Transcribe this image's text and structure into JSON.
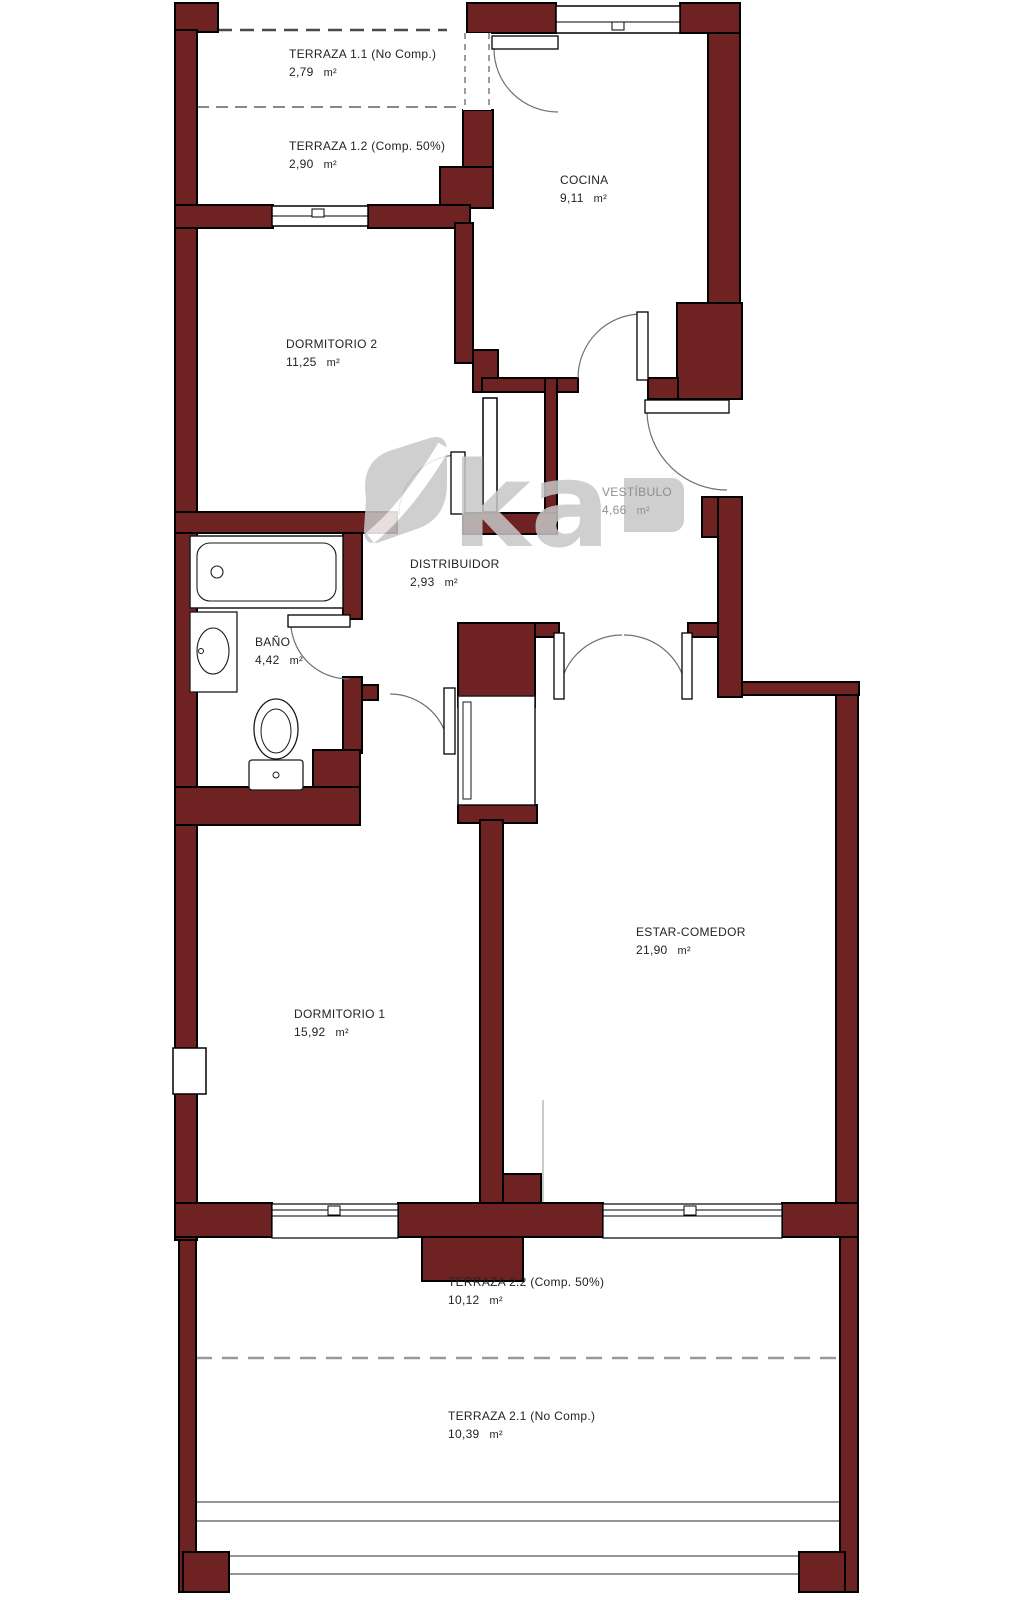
{
  "title": "Plano de vivienda (floor plan)",
  "unit": "m²",
  "colors": {
    "wall": "#6e2222",
    "outline": "#000000",
    "fixture_line": "#1a1a1a",
    "door_arc": "#6f6f6f",
    "dashed_line": "#8a8a8a",
    "watermark": "#c7c7c7",
    "label_text": "#232323",
    "label_text_muted": "#8f8f8f"
  },
  "watermark": {
    "text": "ka"
  },
  "fixtures": [
    "bathtub",
    "washbasin",
    "toilet",
    "wardrobe"
  ],
  "rooms": [
    {
      "id": "terraza-1-1",
      "name": "TERRAZA 1.1 (No Comp.)",
      "area": "2,79"
    },
    {
      "id": "terraza-1-2",
      "name": "TERRAZA 1.2 (Comp. 50%)",
      "area": "2,90"
    },
    {
      "id": "cocina",
      "name": "COCINA",
      "area": "9,11"
    },
    {
      "id": "dormitorio-2",
      "name": "DORMITORIO 2",
      "area": "11,25"
    },
    {
      "id": "vestibulo",
      "name": "VESTÍBULO",
      "area": "4,66"
    },
    {
      "id": "distribuidor",
      "name": "DISTRIBUIDOR",
      "area": "2,93"
    },
    {
      "id": "bano",
      "name": "BAÑO",
      "area": "4,42"
    },
    {
      "id": "dormitorio-1",
      "name": "DORMITORIO 1",
      "area": "15,92"
    },
    {
      "id": "estar-comedor",
      "name": "ESTAR-COMEDOR",
      "area": "21,90"
    },
    {
      "id": "terraza-2-2",
      "name": "TERRAZA 2.2 (Comp. 50%)",
      "area": "10,12"
    },
    {
      "id": "terraza-2-1",
      "name": "TERRAZA 2.1 (No Comp.)",
      "area": "10,39"
    }
  ]
}
